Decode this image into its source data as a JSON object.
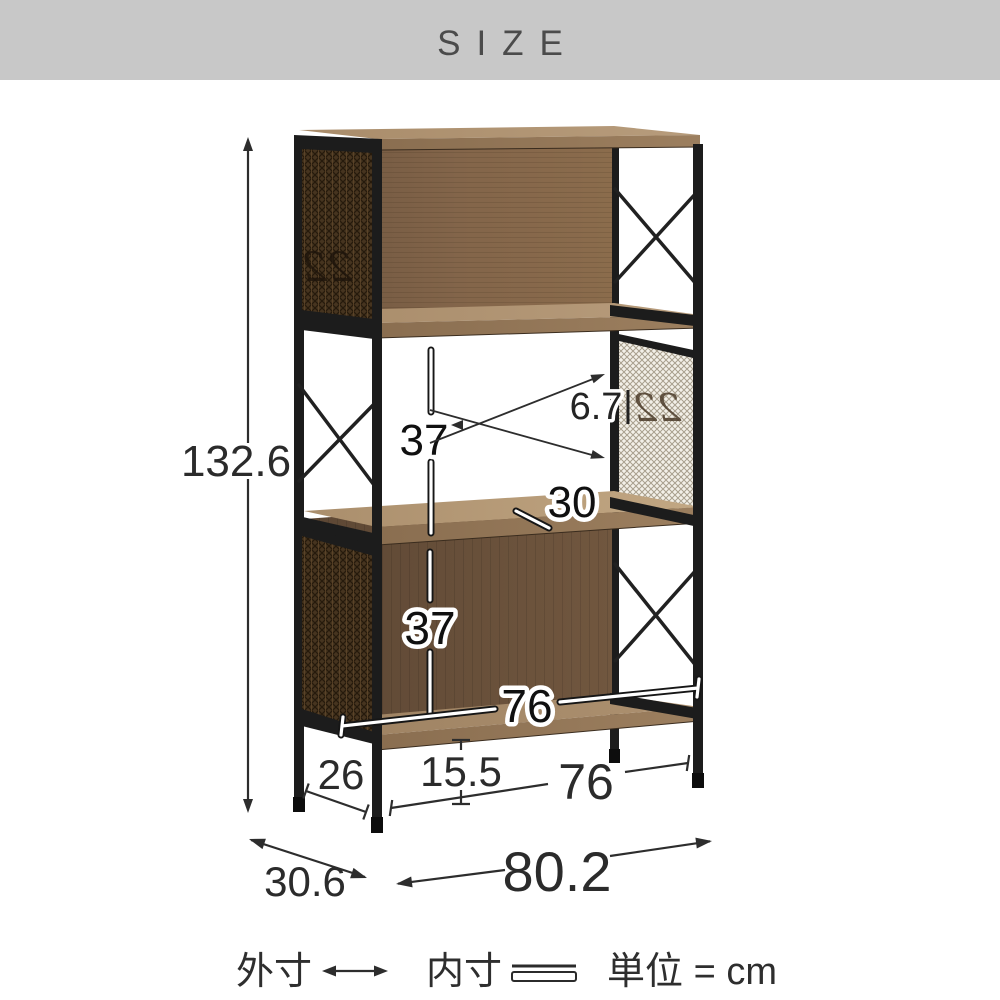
{
  "header": {
    "title": "SIZE"
  },
  "legend": {
    "outer_label": "外寸",
    "inner_label": "内寸",
    "unit_label": "単位 = cm"
  },
  "dimensions": {
    "total_height": "132.6",
    "shelf_inner_height": "37",
    "mesh_inset": "6.7",
    "shelf_inner_depth": "30",
    "lower_inner_height": "37",
    "inner_width": "76",
    "side_foot_depth": "26",
    "foot_height": "15.5",
    "front_foot_span": "76",
    "total_width": "80.2",
    "total_depth": "30.6"
  },
  "decor": {
    "mesh_monogram": "22"
  },
  "colors": {
    "header_bg": "#c8c8c8",
    "frame_black": "#1c1c1c",
    "wood_light": "#b0937a",
    "wood_dark": "#6b5340",
    "mesh_dark": "#46341f",
    "mesh_light": "#f3f0e8",
    "dim_line": "#2d2d2d"
  }
}
